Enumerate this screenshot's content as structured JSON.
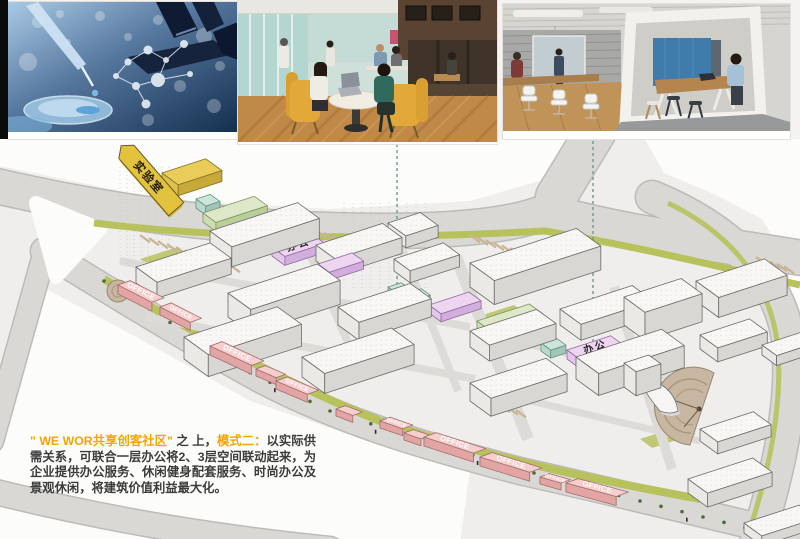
{
  "slide": {
    "background": "#f4f3f1"
  },
  "photos": [
    {
      "id": "laboratory",
      "name": "laboratory-research-photo"
    },
    {
      "id": "coworking-cafe",
      "name": "coworking-cafe-photo"
    },
    {
      "id": "office-pod",
      "name": "office-meeting-pod-photo"
    }
  ],
  "plan": {
    "flag_label": "实验室",
    "office_label_cn": "办公",
    "office_label_en": "OFFICE",
    "accent_colors": {
      "yellow": "#e9cd58",
      "mint": "#cbe5dc",
      "green": "#dce8c8",
      "purple": "#eed5f2",
      "pink": "#f5cecd",
      "white": "#f8f7f5",
      "road": "#d9d8d5",
      "landscape": "#b7c25d",
      "plaza": "#c7b6a2"
    },
    "connectors": [
      {
        "x": 397,
        "y1": 5,
        "y2": 168
      },
      {
        "x": 593,
        "y1": 2,
        "y2": 222
      }
    ],
    "tree_line": [
      [
        104,
        142
      ],
      [
        150,
        170
      ],
      [
        230,
        224
      ],
      [
        330,
        272
      ],
      [
        432,
        304
      ],
      [
        534,
        334
      ],
      [
        640,
        362
      ],
      [
        766,
        394
      ]
    ],
    "buildings": [
      {
        "x": 162,
        "y": 34,
        "w": 46,
        "d": 20,
        "h": 11,
        "c": "yellow"
      },
      {
        "x": 196,
        "y": 60,
        "w": 15,
        "d": 12,
        "h": 9,
        "c": "mint"
      },
      {
        "x": 203,
        "y": 74,
        "w": 54,
        "d": 16,
        "h": 9,
        "c": "green"
      },
      {
        "x": 259,
        "y": 100,
        "w": 15,
        "d": 12,
        "h": 8,
        "c": "mint"
      },
      {
        "x": 272,
        "y": 108,
        "w": 42,
        "d": 16,
        "h": 9,
        "c": "purple",
        "label": "办公",
        "fs": 10,
        "ls": 2
      },
      {
        "x": 318,
        "y": 125,
        "w": 36,
        "d": 14,
        "h": 8,
        "c": "purple"
      },
      {
        "x": 388,
        "y": 148,
        "w": 14,
        "d": 11,
        "h": 8,
        "c": "mint"
      },
      {
        "x": 408,
        "y": 154,
        "w": 14,
        "d": 11,
        "h": 8,
        "c": "mint"
      },
      {
        "x": 429,
        "y": 166,
        "w": 42,
        "d": 15,
        "h": 8,
        "c": "purple"
      },
      {
        "x": 477,
        "y": 182,
        "w": 55,
        "d": 17,
        "h": 8,
        "c": "green"
      },
      {
        "x": 541,
        "y": 204,
        "w": 16,
        "d": 12,
        "h": 8,
        "c": "mint"
      },
      {
        "x": 567,
        "y": 211,
        "w": 46,
        "d": 16,
        "h": 9,
        "c": "purple",
        "label": "办公",
        "fs": 10,
        "ls": 2
      },
      {
        "x": 388,
        "y": 84,
        "w": 34,
        "d": 22,
        "h": 12,
        "c": "white"
      },
      {
        "x": 210,
        "y": 92,
        "w": 92,
        "d": 27,
        "h": 20,
        "c": "white"
      },
      {
        "x": 316,
        "y": 106,
        "w": 70,
        "d": 24,
        "h": 16,
        "c": "white"
      },
      {
        "x": 394,
        "y": 120,
        "w": 52,
        "d": 20,
        "h": 12,
        "c": "white"
      },
      {
        "x": 470,
        "y": 124,
        "w": 112,
        "d": 30,
        "h": 24,
        "c": "white"
      },
      {
        "x": 696,
        "y": 142,
        "w": 72,
        "d": 28,
        "h": 20,
        "c": "white"
      },
      {
        "x": 136,
        "y": 128,
        "w": 78,
        "d": 26,
        "h": 16,
        "c": "white"
      },
      {
        "x": 560,
        "y": 170,
        "w": 76,
        "d": 26,
        "h": 16,
        "c": "white"
      },
      {
        "x": 228,
        "y": 154,
        "w": 94,
        "d": 28,
        "h": 24,
        "c": "white"
      },
      {
        "x": 338,
        "y": 168,
        "w": 76,
        "d": 26,
        "h": 18,
        "c": "white"
      },
      {
        "x": 470,
        "y": 192,
        "w": 70,
        "d": 24,
        "h": 16,
        "c": "white"
      },
      {
        "x": 624,
        "y": 158,
        "w": 60,
        "d": 26,
        "h": 28,
        "c": "white"
      },
      {
        "x": 762,
        "y": 206,
        "w": 40,
        "d": 18,
        "h": 10,
        "c": "white"
      },
      {
        "x": 184,
        "y": 198,
        "w": 98,
        "d": 30,
        "h": 22,
        "c": "white"
      },
      {
        "x": 302,
        "y": 218,
        "w": 94,
        "d": 28,
        "h": 20,
        "c": "white"
      },
      {
        "x": 576,
        "y": 218,
        "w": 90,
        "d": 28,
        "h": 22,
        "c": "white"
      },
      {
        "x": 700,
        "y": 196,
        "w": 52,
        "d": 22,
        "h": 14,
        "c": "white"
      },
      {
        "x": 470,
        "y": 244,
        "w": 80,
        "d": 26,
        "h": 18,
        "c": "white"
      },
      {
        "x": 624,
        "y": 224,
        "w": 26,
        "d": 15,
        "h": 24,
        "c": "white"
      },
      {
        "x": 700,
        "y": 290,
        "w": 56,
        "d": 22,
        "h": 12,
        "c": "white"
      },
      {
        "x": 688,
        "y": 340,
        "w": 68,
        "d": 24,
        "h": 14,
        "c": "white"
      },
      {
        "x": 744,
        "y": 384,
        "w": 58,
        "d": 22,
        "h": 10,
        "c": "white"
      },
      {
        "x": 118,
        "y": 146,
        "a": 27,
        "w": 38,
        "d": 13,
        "h": 9,
        "c": "pink",
        "label": "OFFICE"
      },
      {
        "x": 160,
        "y": 168,
        "a": 27,
        "w": 34,
        "d": 12,
        "h": 8,
        "c": "pink",
        "label": "OFFICE",
        "fs": 6
      },
      {
        "x": 190,
        "y": 198,
        "a": 25,
        "w": 20,
        "d": 10,
        "h": 7,
        "c": "pink"
      },
      {
        "x": 210,
        "y": 207,
        "a": 25,
        "w": 46,
        "d": 13,
        "h": 9,
        "c": "pink",
        "label": "OFFICE"
      },
      {
        "x": 256,
        "y": 230,
        "a": 23,
        "w": 22,
        "d": 10,
        "h": 7,
        "c": "pink"
      },
      {
        "x": 276,
        "y": 242,
        "a": 23,
        "w": 34,
        "d": 12,
        "h": 8,
        "c": "pink",
        "label": "OFFICE",
        "fs": 6
      },
      {
        "x": 336,
        "y": 270,
        "a": 21,
        "w": 18,
        "d": 10,
        "h": 7,
        "c": "pink"
      },
      {
        "x": 380,
        "y": 282,
        "a": 19,
        "w": 24,
        "d": 11,
        "h": 7,
        "c": "pink",
        "label": "OFFICE",
        "fs": 5
      },
      {
        "x": 404,
        "y": 294,
        "a": 19,
        "w": 18,
        "d": 10,
        "h": 7,
        "c": "pink"
      },
      {
        "x": 424,
        "y": 298,
        "a": 18,
        "w": 52,
        "d": 13,
        "h": 9,
        "c": "pink",
        "label": "OFFICE"
      },
      {
        "x": 480,
        "y": 318,
        "a": 17,
        "w": 52,
        "d": 13,
        "h": 9,
        "c": "pink",
        "label": "OFFICE"
      },
      {
        "x": 540,
        "y": 338,
        "a": 16,
        "w": 22,
        "d": 10,
        "h": 7,
        "c": "pink",
        "label": "OFFICE",
        "fs": 5
      },
      {
        "x": 566,
        "y": 344,
        "a": 15,
        "w": 52,
        "d": 13,
        "h": 9,
        "c": "pink",
        "label": "OFFICE"
      }
    ]
  },
  "caption": {
    "lead": "\" WE WOR共享创客社区\"",
    "mid": " 之 上，",
    "mode": "模式二：",
    "body": "以实际供需关系，可联合一层办公将2、3层空间联动起来，为企业提供办公服务、休闲健身配套服务、时尚办公及景观休闲，将建筑价值利益最大化。",
    "accent_color": "#F5A400",
    "text_color": "#3C3C3C"
  }
}
